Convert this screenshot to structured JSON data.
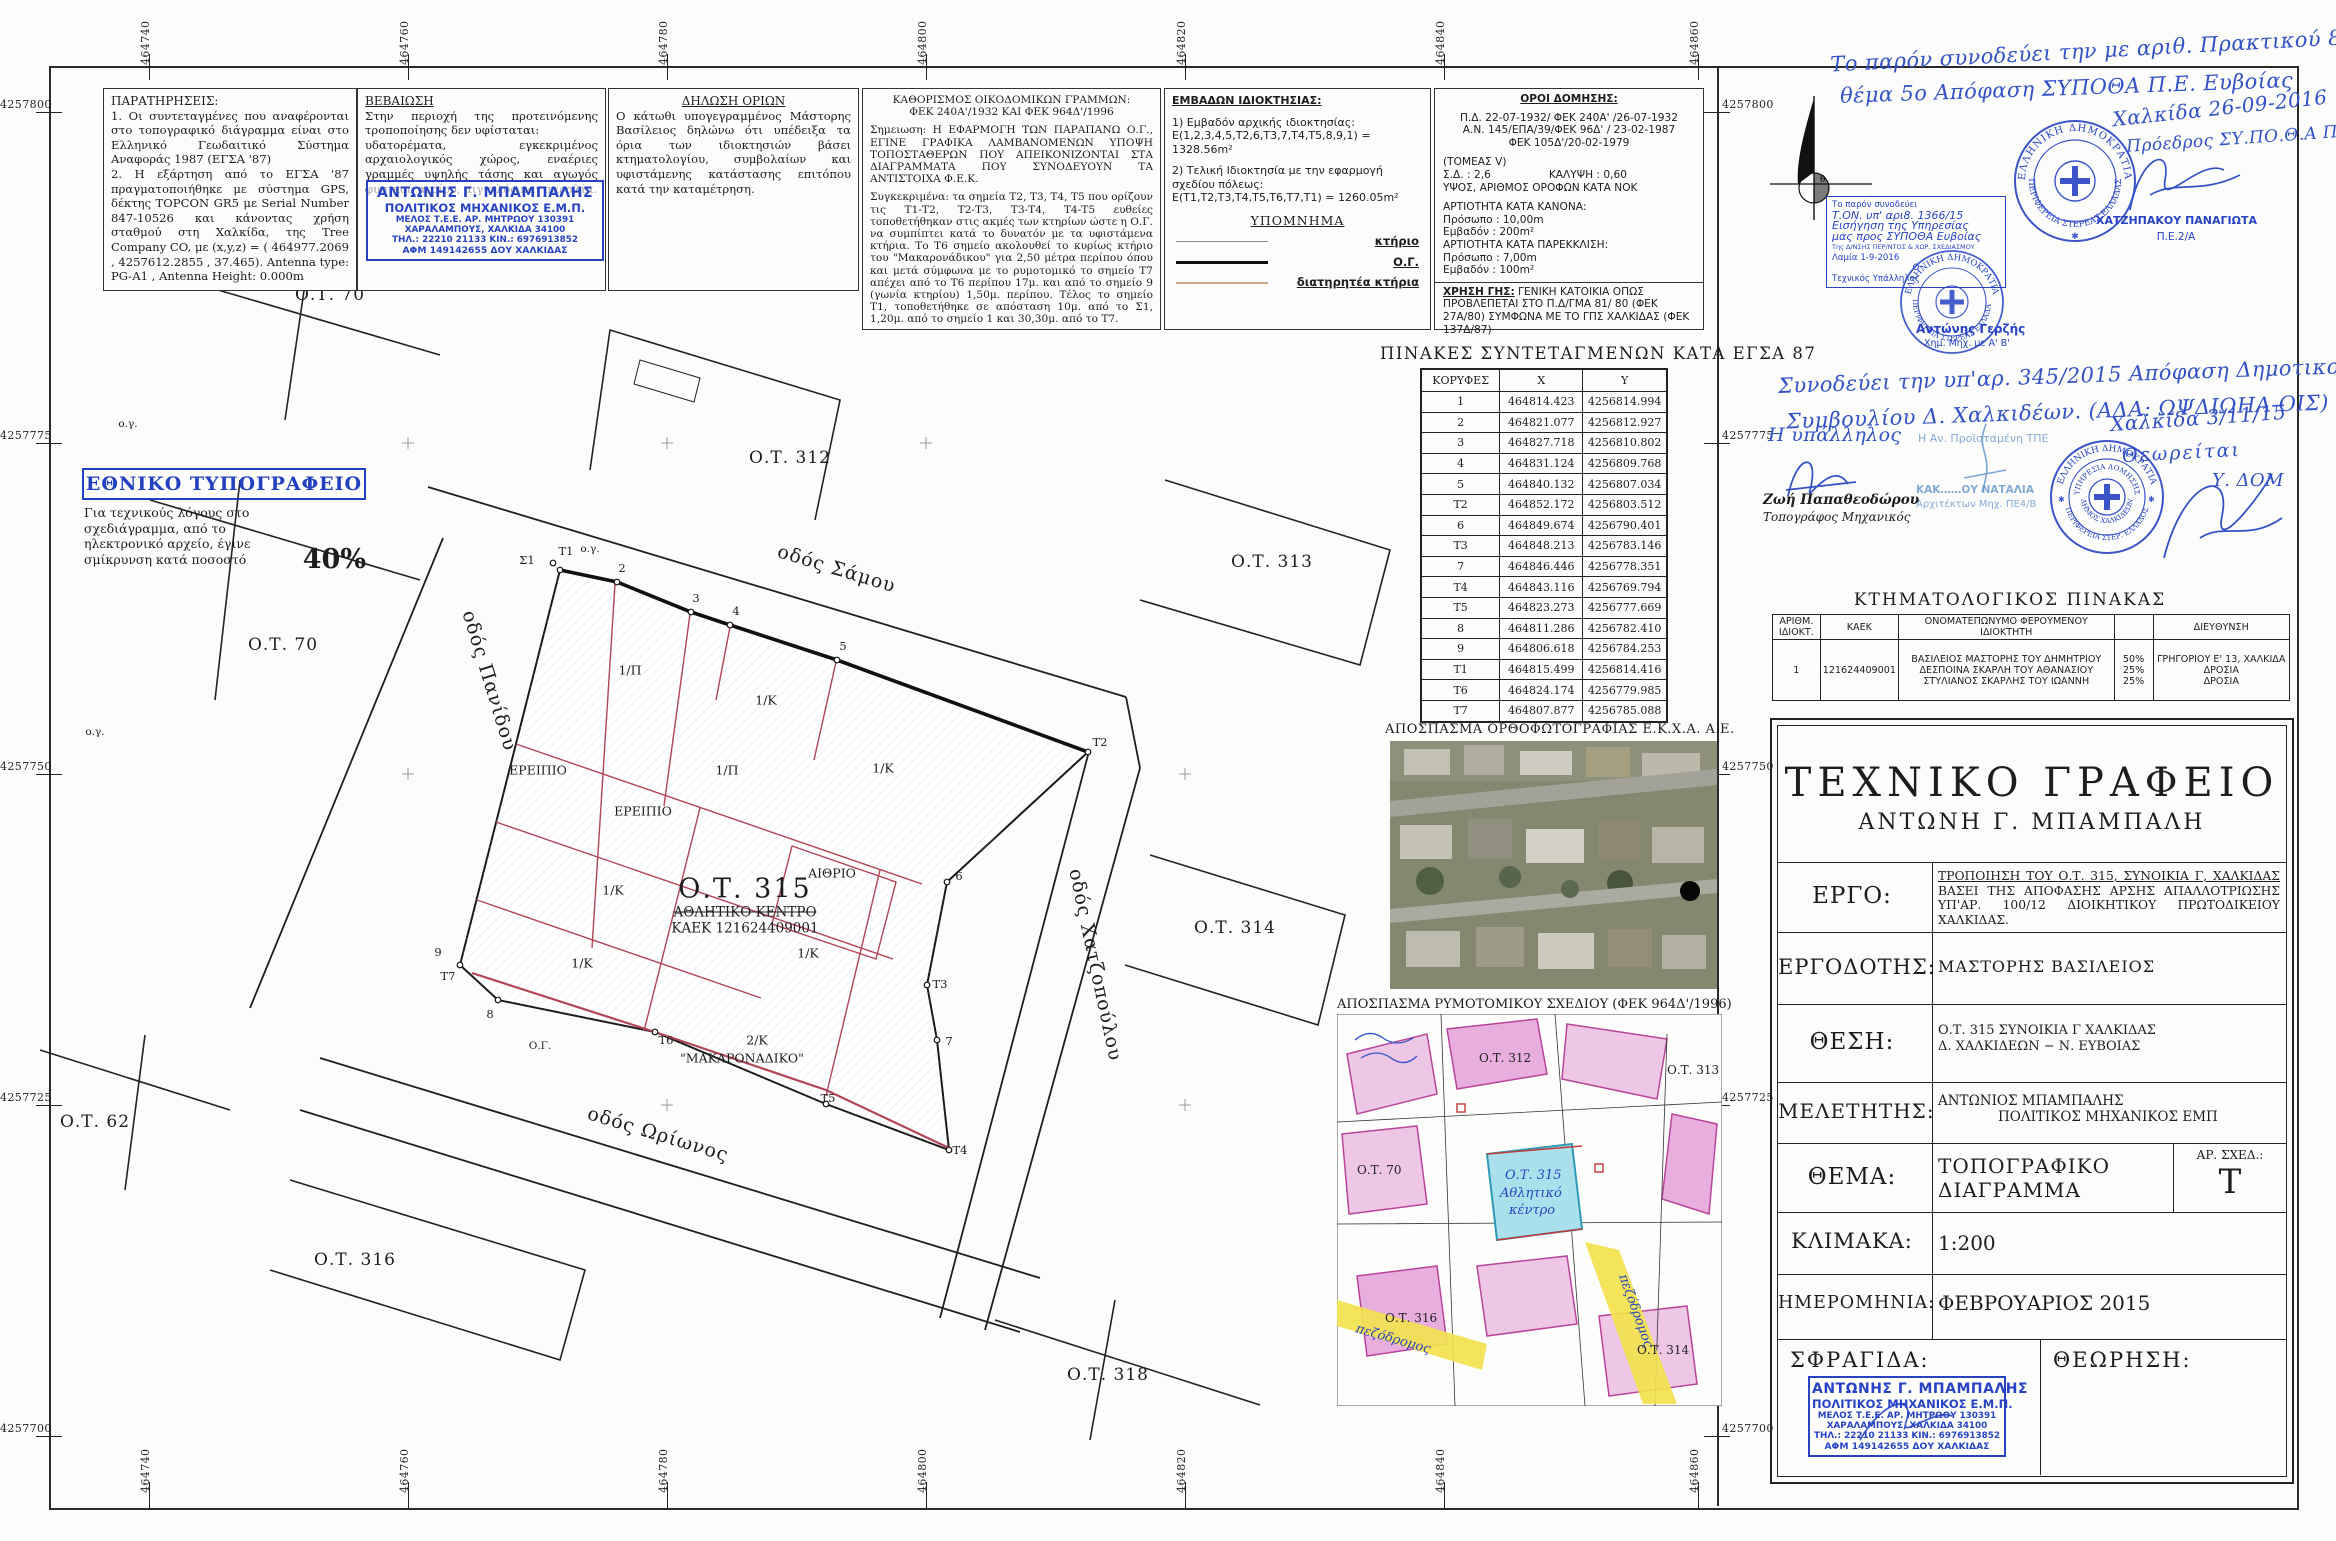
{
  "frame": {
    "x_ticks": [
      {
        "x": 149,
        "label": "464740"
      },
      {
        "x": 408,
        "label": "464760"
      },
      {
        "x": 667,
        "label": "464780"
      },
      {
        "x": 926,
        "label": "464800"
      },
      {
        "x": 1185,
        "label": "464820"
      },
      {
        "x": 1444,
        "label": "464840"
      },
      {
        "x": 1698,
        "label": "464860"
      }
    ],
    "y_ticks": [
      {
        "y": 112,
        "label": "4257800"
      },
      {
        "y": 443,
        "label": "4257775"
      },
      {
        "y": 774,
        "label": "4257750"
      },
      {
        "y": 1105,
        "label": "4257725"
      },
      {
        "y": 1436,
        "label": "4257700"
      }
    ]
  },
  "notes": {
    "paratiriseis": {
      "title": "ΠΑΡΑΤΗΡΗΣΕΙΣ:",
      "body": "1. Οι συντεταγμένες που αναφέρονται στο τοπογραφικό διάγραμμα είναι στο Ελληνικό Γεωδαιτικό Σύστημα Αναφοράς 1987 (ΕΓΣΑ '87)\n2. Η εξάρτηση από το ΕΓΣΑ '87 πραγματοποιήθηκε με σύστημα GPS, δέκτης TOPCON GR5 με Serial Number 847-10526 και κάνοντας χρήση σταθμού στη Χαλκίδα, της Tree Company CO, με (x,y,z) = ( 464977.2069 , 4257612.2855 , 37.465). Antenna type: PG-A1 , Antenna Height: 0.000m"
    },
    "vevaiosi": {
      "title": "ΒΕΒΑΙΩΣΗ",
      "body": "Στην περιοχή της προτεινόμενης τροποποίησης δεν υφίσταται:\nυδατορέματα, εγκεκριμένος αρχαιολογικός χώρος, εναέριες γραμμές υψηλής τάσης και αγωγός φυσικού αερίου, αιγιαλός και παραλία."
    },
    "dilosi": {
      "title": "ΔΗΛΩΣΗ ΟΡΙΩΝ",
      "body": "Ο κάτωθι υπογεγραμμένος Μάστορης Βασίλειος δηλώνω ότι υπέδειξα τα όρια των ιδιοκτησιών βάσει κτηματολογίου, συμβολαίων και υφιστάμενης κατάστασης επιτόπου κατά την καταμέτρηση."
    },
    "kathorismos": {
      "title1": "ΚΑΘΟΡΙΣΜΟΣ ΟΙΚΟΔΟΜΙΚΩΝ ΓΡΑΜΜΩΝ:",
      "title2": "ΦΕΚ 240Α'/1932 ΚΑΙ ΦΕΚ 964Δ'/1996",
      "p1": "Σημειωση: Η ΕΦΑΡΜΟΓΗ ΤΩΝ ΠΑΡΑΠΑΝΩ Ο.Γ., ΕΓΙΝΕ ΓΡΑΦΙΚΑ ΛΑΜΒΑΝΟΜΕΝΩΝ ΥΠΟΨΗ ΤΟΠΟΣΤΑΘΕΡΩΝ ΠΟΥ ΑΠΕΙΚΟΝΙΖΟΝΤΑΙ ΣΤΑ ΔΙΑΓΡΑΜΜΑΤΑ ΠΟΥ ΣΥΝΟΔΕΥΟΥΝ ΤΑ ΑΝΤΙΣΤΟΙΧΑ Φ.Ε.Κ.",
      "p2": "Συγκεκριμένα: τα σημεία Τ2, Τ3, Τ4, Τ5 που ορίζουν τις Τ1-Τ2, Τ2-Τ3, Τ3-Τ4, Τ4-Τ5 ευθείες τοποθετήθηκαν στις ακμές των κτηρίων ώστε η Ο.Γ. να συμπίπτει κατά το δυνατόν με τα υφιστάμενα κτήρια. Το Τ6 σημείο ακολουθεί το κυρίως κτήριο του \"Μακαρονάδικου\" για 2,50 μέτρα περίπου όπου και μετά σύμφωνα με το ρυμοτομικό το σημείο Τ7 απέχει από το Τ6 περίπου 17μ. και από το σημείο 9 (γωνία κτηρίου) 1,50μ. περίπου. Τέλος το σημείο Τ1, τοποθετήθηκε σε απόσταση 10μ. από το Σ1, 1,20μ. από το σημείο 1 και 30,30μ. από το Τ7."
    },
    "emvadon": {
      "title": "ΕΜΒΑΔΩΝ ΙΔΙΟΚΤΗΣΙΑΣ:",
      "l1": "1) Εμβαδόν αρχικής ιδιοκτησίας:",
      "l2": "Ε(1,2,3,4,5,Τ2,6,Τ3,7,Τ4,Τ5,8,9,1) = 1328.56m²",
      "l3": "2) Τελική Ιδιοκτησία με την εφαρμογή σχεδίου πόλεως:",
      "l4": "Ε(Τ1,Τ2,Τ3,Τ4,Τ5,Τ6,Τ7,Τ1) = 1260.05m²"
    },
    "ypomnima": {
      "title": "ΥΠΟΜΝΗΜΑ",
      "items": [
        {
          "label": "κτήριο",
          "style": "thin"
        },
        {
          "label": "Ο.Γ.",
          "style": "thick"
        },
        {
          "label": "διατηρητέα κτήρια",
          "style": "tan"
        }
      ]
    },
    "oroi": {
      "title": "ΟΡΟΙ ΔΟΜΗΣΗΣ:",
      "fek1": "Π.Δ. 22-07-1932/ ΦΕΚ 240Α' /26-07-1932",
      "fek2": "Α.Ν. 145/ΕΠΑ/39/ΦΕΚ 96Δ' / 23-02-1987",
      "fek3": "ΦΕΚ 105Δ'/20-02-1979",
      "tomeas": "(ΤΟΜΕΑΣ V)",
      "sd": "Σ.Δ. : 2,6",
      "kalypsi": "ΚΑΛΥΨΗ : 0,60",
      "ypsos": "ΥΨΟΣ, ΑΡΙΘΜΟΣ ΟΡΟΦΩΝ ΚΑΤΑ ΝΟΚ",
      "art1": "ΑΡΤΙΟΤΗΤΑ ΚΑΤΑ ΚΑΝΟΝΑ:",
      "pros1": "Πρόσωπο : 10,00m",
      "emv1": "Εμβαδόν : 200m²",
      "art2": "ΑΡΤΙΟΤΗΤΑ ΚΑΤΑ ΠΑΡΕΚΚΛΙΣΗ:",
      "pros2": "Πρόσωπο : 7,00m",
      "emv2": "Εμβαδόν : 100m²",
      "xrisi_label": "ΧΡΗΣΗ ΓΗΣ:",
      "xrisi_body": " ΓΕΝΙΚΗ ΚΑΤΟΙΚΙΑ ΟΠΩΣ ΠΡΟΒΛΕΠΕΤΑΙ ΣΤΟ Π.Δ/ΓΜΑ 81/ 80 (ΦΕΚ 27Α/80) ΣΥΜΦΩΝΑ ΜΕ ΤΟ ΓΠΣ ΧΑΛΚΙΔΑΣ (ΦΕΚ 137Δ/87)"
    }
  },
  "reduction_note": {
    "title": "ΕΘΝΙΚΟ ΤΥΠΟΓΡΑΦΕΙΟ",
    "body": "Για τεχνικούς λόγους στο σχεδιάγραμμα, από το ηλεκτρονικό αρχείο, έγινε σμίκρυνση κατά ποσοστό",
    "percent": "40%"
  },
  "engineer_stamp": {
    "lines": [
      "ΑΝΤΩΝΗΣ Γ. ΜΠΑΜΠΑΛΗΣ",
      "ΠΟΛΙΤΙΚΟΣ ΜΗΧΑΝΙΚΟΣ Ε.Μ.Π.",
      "ΜΕΛΟΣ Τ.Ε.Ε. ΑΡ. ΜΗΤΡΩΟΥ 130391",
      "ΧΑΡΑΛΑΜΠΟΥΣ, ΧΑΛΚΙΔΑ 34100",
      "ΤΗΛ.: 22210 21133  ΚΙΝ.: 6976913852",
      "ΑΦΜ 149142655   ΔΟΥ ΧΑΛΚΙΔΑΣ"
    ]
  },
  "coords_table": {
    "title": "ΠΙΝΑΚΕΣ ΣΥΝΤΕΤΑΓΜΕΝΩΝ ΚΑΤΑ ΕΓΣΑ 87",
    "headers": [
      "ΚΟΡΥΦΕΣ",
      "Χ",
      "Υ"
    ],
    "rows": [
      [
        "1",
        "464814.423",
        "4256814.994"
      ],
      [
        "2",
        "464821.077",
        "4256812.927"
      ],
      [
        "3",
        "464827.718",
        "4256810.802"
      ],
      [
        "4",
        "464831.124",
        "4256809.768"
      ],
      [
        "5",
        "464840.132",
        "4256807.034"
      ],
      [
        "Τ2",
        "464852.172",
        "4256803.512"
      ],
      [
        "6",
        "464849.674",
        "4256790.401"
      ],
      [
        "Τ3",
        "464848.213",
        "4256783.146"
      ],
      [
        "7",
        "464846.446",
        "4256778.351"
      ],
      [
        "Τ4",
        "464843.116",
        "4256769.794"
      ],
      [
        "Τ5",
        "464823.273",
        "4256777.669"
      ],
      [
        "8",
        "464811.286",
        "4256782.410"
      ],
      [
        "9",
        "464806.618",
        "4256784.253"
      ],
      [
        "Τ1",
        "464815.499",
        "4256814.416"
      ],
      [
        "Τ6",
        "464824.174",
        "4256779.985"
      ],
      [
        "Τ7",
        "464807.877",
        "4256785.088"
      ]
    ]
  },
  "orthophoto": {
    "title": "ΑΠΟΣΠΑΣΜΑ ΟΡΘΟΦΩΤΟΓΡΑΦΙΑΣ Ε.Κ.Χ.Α. Α.Ε."
  },
  "rymotomiko": {
    "title": "ΑΠΟΣΠΑΣΜΑ ΡΥΜΟΤΟΜΙΚΟΥ ΣΧΕΔΙΟΥ (ΦΕΚ 964Δ'/1996)",
    "ot312": "Ο.Τ. 312",
    "ot70": "Ο.Τ. 70",
    "ot313": "Ο.Τ. 313",
    "ot316": "Ο.Τ. 316",
    "ot314": "Ο.Τ. 314",
    "ot315_hand": "Ο.Τ. 315",
    "athlitiko_hand": "Αθλητικό",
    "kentro_hand": "κέντρο",
    "pezodromos": "πεζόδρομος"
  },
  "cadastral": {
    "title": "ΚΤΗΜΑΤΟΛΟΓΙΚΟΣ  ΠΙΝΑΚΑΣ",
    "headers": [
      "ΑΡΙΘΜ. ΙΔΙΟΚΤ.",
      "ΚΑΕΚ",
      "ΟΝΟΜΑΤΕΠΩΝΥΜΟ ΦΕΡΟΥΜΕΝΟΥ ΙΔΙΟΚΤΗΤΗ",
      "",
      "ΔΙΕΥΘΥΝΣΗ"
    ],
    "row": {
      "num": "1",
      "kaek": "121624409001",
      "owners": [
        "ΒΑΣΙΛΕΙΟΣ ΜΑΣΤΟΡΗΣ ΤΟΥ ΔΗΜΗΤΡΙΟΥ",
        "ΔΕΣΠΟΙΝΑ ΣΚΑΡΛΗ ΤΟΥ ΑΘΑΝΑΣΙΟΥ",
        "ΣΤΥΛΙΑΝΟΣ ΣΚΑΡΛΗΣ ΤΟΥ ΙΩΑΝΝΗ"
      ],
      "percents": [
        "50%",
        "25%",
        "25%"
      ],
      "addresses": [
        "ΓΡΗΓΟΡΙΟΥ Ε' 13, ΧΑΛΚΙΔΑ",
        "ΔΡΟΣΙΑ",
        "ΔΡΟΣΙΑ"
      ]
    }
  },
  "title_block": {
    "office": "ΤΕΧΝΙΚΟ  ΓΡΑΦΕΙΟ",
    "office_sub": "ΑΝΤΩΝΗ  Γ.  ΜΠΑΜΠΑΛΗ",
    "ergo_label": "ΕΡΓΟ:",
    "ergo_l1": "ΤΡΟΠΟΙΗΣΗ ΤΟΥ Ο.Τ. 315, ΣΥΝΟΙΚΙΑ Γ, ΧΑΛΚΙΔΑΣ",
    "ergo_rest": "ΒΑΣΕΙ ΤΗΣ ΑΠΟΦΑΣΗΣ ΑΡΣΗΣ ΑΠΑΛΛΟΤΡΙΩΣΗΣ ΥΠ'ΑΡ. 100/12 ΔΙΟΙΚΗΤΙΚΟΥ ΠΡΩΤΟΔΙΚΕΙΟΥ ΧΑΛΚΙΔΑΣ.",
    "ergodotis_label": "ΕΡΓΟΔΟΤΗΣ:",
    "ergodotis": "ΜΑΣΤΟΡΗΣ  ΒΑΣΙΛΕΙΟΣ",
    "thesi_label": "ΘΕΣΗ:",
    "thesi_l1": "Ο.Τ. 315  ΣΥΝΟΙΚΙΑ Γ  ΧΑΛΚΙΔΑΣ",
    "thesi_l2": "Δ. ΧΑΛΚΙΔΕΩΝ − Ν. ΕΥΒΟΙΑΣ",
    "meletitis_label": "ΜΕΛΕΤΗΤΗΣ:",
    "meletitis_l1": "ΑΝΤΩΝΙΟΣ  ΜΠΑΜΠΑΛΗΣ",
    "meletitis_l2": "ΠΟΛΙΤΙΚΟΣ  ΜΗΧΑΝΙΚΟΣ  ΕΜΠ",
    "thema_label": "ΘΕΜΑ:",
    "thema_l1": "ΤΟΠΟΓΡΑΦΙΚΟ",
    "thema_l2": "ΔΙΑΓΡΑΜΜΑ",
    "ar_sxed_label": "ΑΡ. ΣΧΕΔ.:",
    "ar_sxed": "T",
    "klimaka_label": "ΚΛΙΜΑΚΑ:",
    "klimaka": "1:200",
    "imerominia_label": "ΗΜΕΡΟΜΗΝΙΑ:",
    "imerominia": "ΦΕΒΡΟΥΑΡΙΟΣ  2015",
    "sfragida_label": "ΣΦΡΑΓΙΔΑ:",
    "theorisi_label": "ΘΕΩΡΗΣΗ:"
  },
  "annotations": {
    "note1_l1": "Το παρόν συνοδεύει την με αριθ. Πρακτικού 8/26-9-2016",
    "note1_l2": "θέμα 5ο  Απόφαση  ΣΥΠΟΘΑ  Π.Ε. Ευβοίας",
    "chalkida_date": "Χαλκίδα  26-09-2016",
    "proedros": "Πρόεδρος ΣΥ.ΠΟ.Θ.Α Π.Ε.Ε.",
    "hatzipakou": "ΧΑΤΖΗΠΑΚΟΥ ΠΑΝΑΓΙΩΤΑ",
    "hatzipakou2": "Π.Ε.2/Α",
    "rect_stamp": [
      "Το παρόν συνοδεύει",
      "Τ.ΟΝ. υπ' αρι8. 1366/15",
      "Εισήγηση της Υπηρεσίας",
      "μας προς ΣΥΠΟΘΑ Ευβοίας",
      "Της Δ/ΝΣΗΣ ΠΕΡ/ΝΤΟΣ & ΧΩΡ. ΣΧΕΔΙΑΣΜΟΥ",
      "Λαμία 1-9-2016",
      "Ο",
      "Τεχνικός Υπάλληλος"
    ],
    "gertzis": "Αντώνης Γερζής",
    "gertzis2": "Χημ. Μηχ. με Α' Β'",
    "note2_l1": "Συνοδεύει την υπ'αρ. 345/2015 Απόφαση Δημοτικού",
    "note2_l2": "Συμβουλίου Δ. Χαλκιδέων. (ΑΔΑ: ΩΨΔΙΩΗΑ-ΟΙΣ)",
    "ypallilos": "Η υπάλληλος",
    "papatheodorou_l1": "Ζωή Παπαθεοδώρου",
    "papatheodorou_l2": "Τοπογράφος Μηχανικός",
    "proistameni": "Η Αν. Προϊσταμένη ΤΠΕ",
    "natalia": "ΚΑΚ……ΟΥ ΝΑΤΑΛΙΑ",
    "natalia2": "Αρχιτέκτων Μηχ. ΠΕ4/Β",
    "chalkida2": "Χαλκίδα 3/11/15",
    "theoreitai": "Θεωρείται",
    "ydom": "Υ. ΔΟΜ"
  },
  "round_stamps": {
    "a_top": "ΕΛΛΗΝΙΚΗ ΔΗΜΟΚΡΑΤΙΑ",
    "a_bottom": "ΠΕΡΙΦΕΡΕΙΑ ΣΤΕΡΕΑΣ ΕΛΛΑΔΑΣ",
    "c_top": "ΕΛΛΗΝΙΚΗ ΔΗΜΟΚΡΑΤΙΑ",
    "c_bottom": "ΠΕΡΙΦΕΡΕΙΑ ΣΤΕΡΕΑΣ ΕΛΛΑΔΑΣ",
    "d_top": "ΕΛΛΗΝΙΚΗ ΔΗΜΟΚΡΑΤΙΑ",
    "d_inner_top": "ΥΠΗΡΕΣΙΑ ΔΟΜΗΣΗΣ",
    "d_inner_bottom": "ΔΗΜΟΣ ΧΑΛΚΙΔΕΩΝ",
    "d_bottom": "ΠΕΡΙΦΕΡΕΙΑ ΣΤΕΡ. ΕΛΛΑΔΟΣ"
  },
  "map": {
    "center": {
      "l1": "Ο.Τ. 315",
      "l2": "ΑΘΛΗΤΙΚΟ ΚΕΝΤΡΟ",
      "l3": "ΚΑΕΚ 121624409001"
    },
    "streets": [
      {
        "t": "οδός Σάμου",
        "x": 778,
        "y": 540,
        "rot": 17
      },
      {
        "t": "οδός Πανίδου",
        "x": 468,
        "y": 600,
        "rot": 73
      },
      {
        "t": "οδός Χατζοπούλου",
        "x": 1075,
        "y": 858,
        "rot": 78
      },
      {
        "t": "οδός Ωρίωνος",
        "x": 588,
        "y": 1102,
        "rot": 17
      }
    ],
    "blocks": [
      {
        "t": "Ο.Τ. 70",
        "x": 330,
        "y": 295
      },
      {
        "t": "Ο.Τ. 70",
        "x": 283,
        "y": 645
      },
      {
        "t": "Ο.Τ. 312",
        "x": 790,
        "y": 458
      },
      {
        "t": "Ο.Τ. 313",
        "x": 1272,
        "y": 562
      },
      {
        "t": "Ο.Τ. 314",
        "x": 1235,
        "y": 928
      },
      {
        "t": "Ο.Τ. 62",
        "x": 95,
        "y": 1122
      },
      {
        "t": "Ο.Τ. 316",
        "x": 355,
        "y": 1260
      },
      {
        "t": "Ο.Τ. 318",
        "x": 1108,
        "y": 1375
      }
    ],
    "parcels": [
      {
        "t": "1/Π",
        "x": 630,
        "y": 670
      },
      {
        "t": "1/Κ",
        "x": 766,
        "y": 700
      },
      {
        "t": "1/Κ",
        "x": 883,
        "y": 768
      },
      {
        "t": "1/Π",
        "x": 727,
        "y": 770
      },
      {
        "t": "ΕΡΕΙΠΙΟ",
        "x": 538,
        "y": 770
      },
      {
        "t": "ΕΡΕΙΠΙΟ",
        "x": 643,
        "y": 811
      },
      {
        "t": "ΑΙΘΡΙΟ",
        "x": 832,
        "y": 873
      },
      {
        "t": "1/Κ",
        "x": 613,
        "y": 890
      },
      {
        "t": "1/Κ",
        "x": 808,
        "y": 953
      },
      {
        "t": "1/Κ",
        "x": 582,
        "y": 963
      },
      {
        "t": "2/Κ",
        "x": 757,
        "y": 1040
      },
      {
        "t": "\"ΜΑΚΑΡΟΝΑΔΙΚΟ\"",
        "x": 742,
        "y": 1058
      }
    ],
    "vertices": [
      {
        "t": "Σ1",
        "x": 527,
        "y": 560
      },
      {
        "t": "T1",
        "x": 566,
        "y": 551
      },
      {
        "t": "2",
        "x": 622,
        "y": 568
      },
      {
        "t": "3",
        "x": 696,
        "y": 598
      },
      {
        "t": "4",
        "x": 736,
        "y": 611
      },
      {
        "t": "5",
        "x": 843,
        "y": 646
      },
      {
        "t": "T2",
        "x": 1100,
        "y": 742
      },
      {
        "t": "6",
        "x": 959,
        "y": 876
      },
      {
        "t": "T3",
        "x": 940,
        "y": 984
      },
      {
        "t": "7",
        "x": 949,
        "y": 1041
      },
      {
        "t": "T4",
        "x": 960,
        "y": 1150
      },
      {
        "t": "T5",
        "x": 828,
        "y": 1098
      },
      {
        "t": "T6",
        "x": 666,
        "y": 1040
      },
      {
        "t": "T7",
        "x": 448,
        "y": 976
      },
      {
        "t": "8",
        "x": 490,
        "y": 1014
      },
      {
        "t": "9",
        "x": 438,
        "y": 952
      }
    ],
    "og": [
      {
        "t": "ο.γ.",
        "x": 590,
        "y": 549
      },
      {
        "t": "Ο.Γ.",
        "x": 540,
        "y": 1046
      },
      {
        "t": "ο.γ.",
        "x": 128,
        "y": 424
      },
      {
        "t": "ο.γ.",
        "x": 95,
        "y": 732
      }
    ]
  }
}
